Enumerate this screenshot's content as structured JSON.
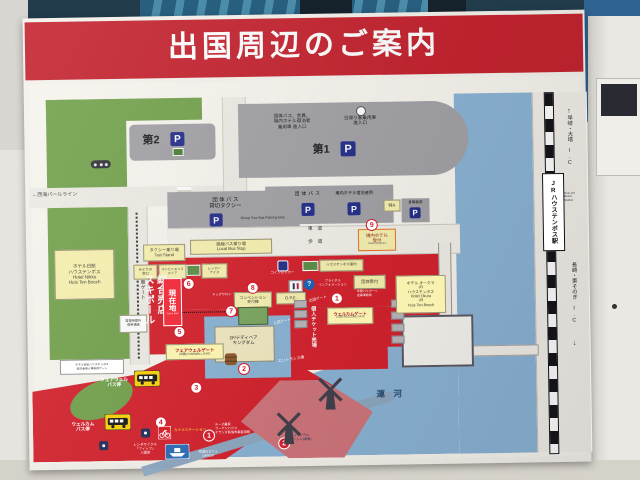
{
  "colors": {
    "signRed": "#c42430",
    "mapRed": "#d5232e",
    "water": "#8cb4d6",
    "green": "#74a24d",
    "parkingGrey": "#a3a2a7",
    "yellowBox": "#f8f1b0",
    "pBlue": "#26308c",
    "pink": "#cf767c"
  },
  "title": "出国周辺のご案内",
  "icons": {
    "question": "?",
    "arrowUp": "↑",
    "arrowDown": "↓",
    "p": "P"
  },
  "top": {
    "p1": "第1",
    "p2": "第2",
    "entranceGroup": "団体バス、会員、\n場内ホテル宿泊者\n乗用車 進入口",
    "entranceDay": "日帰り客乗用車\n進入口",
    "pearlLine": "←西海パールライン"
  },
  "parking": {
    "groupBusTaxi": "団 体 バ ス\n貸切タクシー",
    "groupBusTaxiEn": "Group Tour Bus Parking Area",
    "groupBus": "団体バス",
    "hotelGuest": "場内ホテル宿泊者用",
    "tokuA": "特A",
    "disabled": "身障者用"
  },
  "roads": {
    "shadou": "車　道",
    "hodou": "歩　道",
    "frontRoad": "正面駐車ゲート",
    "localBus": "路線バス乗り場\nLocal Bus Stop",
    "taxi": "タクシー乗り場\nTaxi Stand"
  },
  "reception": {
    "label": "場内ホテル\n受付",
    "en": "Hotel Reception"
  },
  "hotels": {
    "nikko": "ホテル日航\nハウステンボス\nHotel Nikko\nHuis Ten Bosch",
    "okura": "ホテル オークラ\nJR\nハウステンボス\nHotel Okura\nJR\nHuis Ten Bosch",
    "nikkoGate": "ホテル日航ハウステンボス\n宿泊者用入場専用ゲート"
  },
  "facilities": {
    "midori": "みどりの\n窓口",
    "konbini": "コンビニエンス\nストア",
    "ice": "レッカー\nアイス",
    "coinLocker": "コインロッカー",
    "annai": "ハウステンボス案内",
    "convention": "コンベンション\n受付棟",
    "dog": "ドッグサロン",
    "ope": "O.P.E.",
    "bridal": "ブライダル\nインフォメーション",
    "groupDesk": "団体受付",
    "annualPass": "年間パスポート\n会員事務局",
    "souvenir": "総合売店\nスキポール",
    "afterHours": "営業時間外\n専用通路"
  },
  "gates": {
    "genzaichi": "現在地",
    "genzaichiEn": "You're here",
    "farewell": "フェアウェルゲート",
    "farewellEn": "(出国) FAREWELL GATE",
    "welcome": "ウェルカムゲート",
    "welcomeEn": "(入国) WELCOME GATE",
    "kojinTicket": "個人チケット売場",
    "shukkoku": "出国ゲート",
    "nyukoku": "入国ゲート",
    "entranceBldg": "エントランス棟",
    "teddy": "2F/テディベア\nキングダム"
  },
  "south": {
    "farewellBus": "フェアウェル\nバス停",
    "welcomeBus": "ウェルカム\nバス停",
    "rentcycle": "レンタサイクル\n「フィッツ」\n入園店",
    "canalStation": "カナルステーション",
    "canal": "運　河",
    "attr1": "チーズ農家\nブーケンハウス\nオランダ民族衣裳着用館",
    "attr2": "ミュージアム\nモーレン(風車)",
    "cafest": "花畑のカフェ\nCAFEST"
  },
  "station": {
    "jr": "JRハウステンボス駅",
    "jrEn": "Huis Ten\nBosch\nStation",
    "icNorth": "早岐・大塔 I.C",
    "icSouth": "長崎・東そのぎ I.C"
  },
  "nums": {
    "n1": "1",
    "n2": "2",
    "n3": "3",
    "n4": "4",
    "n5": "5",
    "n6": "6",
    "n7": "7",
    "n8": "8",
    "n9": "9"
  }
}
